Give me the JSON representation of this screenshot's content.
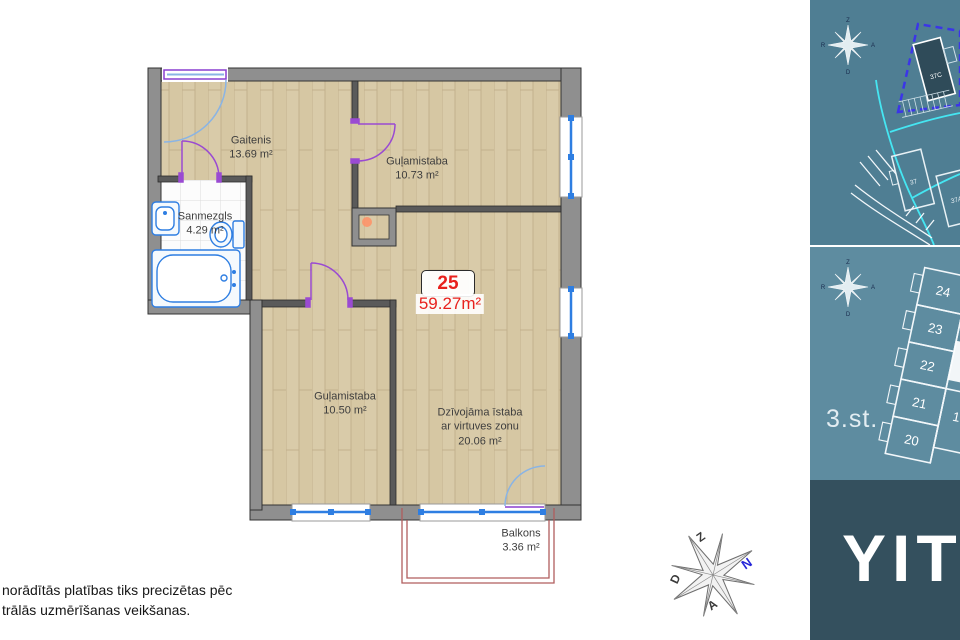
{
  "plan": {
    "unit": {
      "number": "25",
      "area": "59.27m²"
    },
    "rooms": [
      {
        "name": "Gaitenis",
        "area": "13.69 m²"
      },
      {
        "name": "Guļamistaba",
        "area": "10.73 m²"
      },
      {
        "name": "Sanmezgls",
        "area": "4.29 m²"
      },
      {
        "name": "Guļamistaba",
        "area": "10.50 m²"
      },
      {
        "name": "Dzīvojāma īstaba",
        "subtitle": "ar virtuves zonu",
        "area": "20.06 m²"
      },
      {
        "name": "Balkons",
        "area": "3.36 m²"
      }
    ],
    "disclaimer": {
      "line1": "norādītās platības tiks precizētas pēc",
      "line2": "trālās uzmērīšanas veikšanas."
    },
    "compass": {
      "north": "Z",
      "highlight": "N",
      "west": "D",
      "south": "A"
    }
  },
  "sidebar": {
    "site_map": {
      "buildings": [
        "37C",
        "37",
        "37A"
      ]
    },
    "floor_plan": {
      "label": "3.st.",
      "units": [
        "24",
        "23",
        "22",
        "21",
        "20",
        "1"
      ]
    },
    "compass": {
      "n": "Z",
      "e": "A",
      "s": "D",
      "w": "R"
    },
    "logo": "YIT"
  },
  "colors": {
    "accent_red": "#e8211d",
    "window_blue": "#2e7ee2",
    "door_purple": "#9a4ad2",
    "balcony_red": "#b05e5e",
    "teal_top": "#4f7e93",
    "teal_mid": "#5e8ca0",
    "dark_panel": "#34505e",
    "dashed_outline_blue": "#3b35e8",
    "road_cyan": "#45e6f2"
  }
}
